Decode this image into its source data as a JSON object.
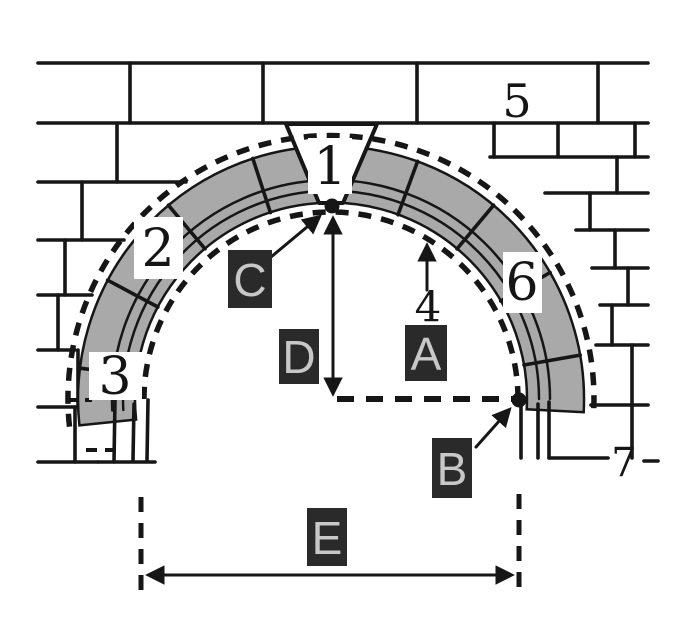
{
  "diagram": {
    "part_labels": {
      "keystone": "1",
      "voussoir": "2",
      "springer": "3",
      "intrados": "4",
      "wall": "5",
      "haunch": "6",
      "abutment": "7"
    },
    "answer_labels": {
      "a": "A",
      "b": "B",
      "c": "C",
      "d": "D",
      "e": "E"
    },
    "colors": {
      "voussoir_gray": "#a9a9a9",
      "line_dark": "#161616",
      "answer_box_bg": "#2a2a2a",
      "answer_box_text": "#c8c8c8",
      "background": "#ffffff"
    }
  }
}
